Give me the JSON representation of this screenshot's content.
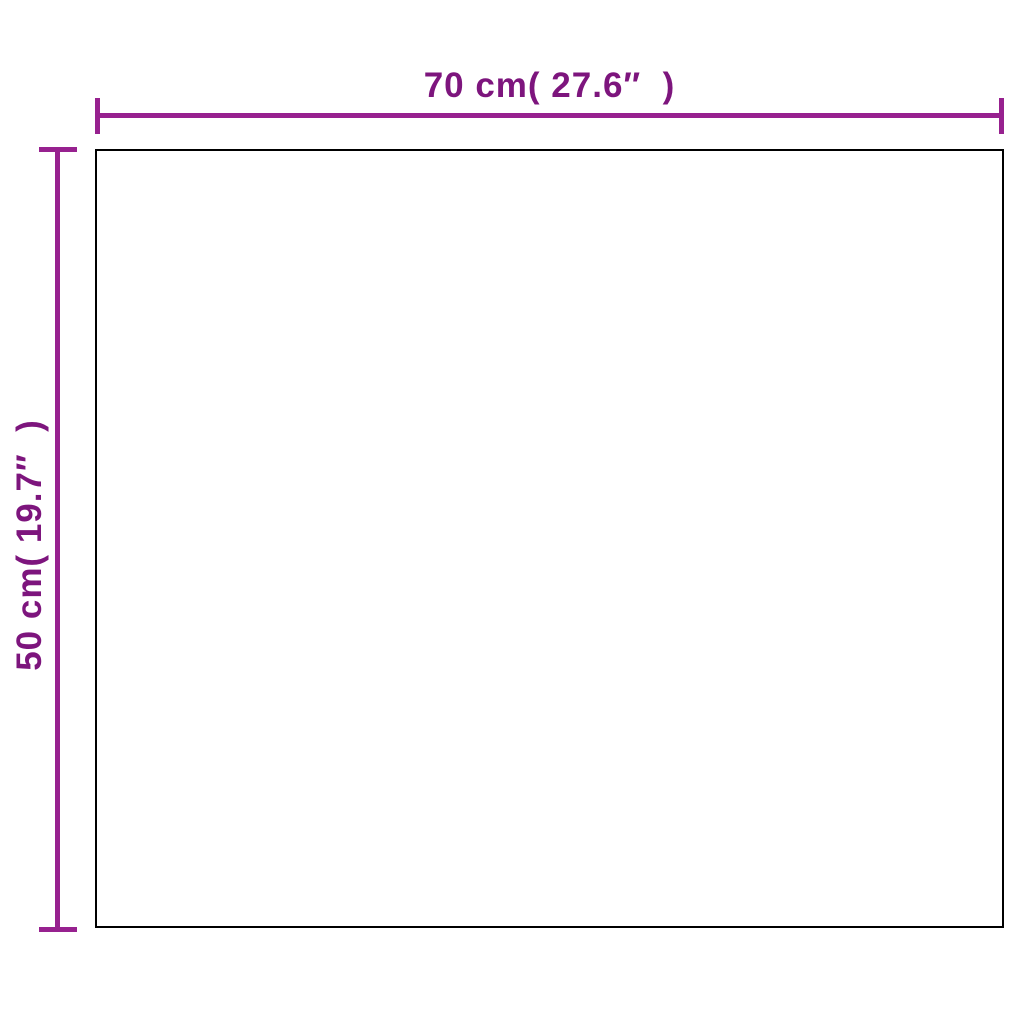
{
  "diagram": {
    "type": "product-dimension-diagram",
    "width_label": "70 cm( 27.6″  )",
    "height_label": "50 cm( 19.7″  )",
    "width_value": "70 cm",
    "width_value_inches": "27.6″",
    "height_value": "50 cm",
    "height_value_inches": "19.7″",
    "colors": {
      "dimension_line": "#97218f",
      "label_text": "#7d157d",
      "rect_border": "#000000",
      "background": "#ffffff"
    }
  }
}
